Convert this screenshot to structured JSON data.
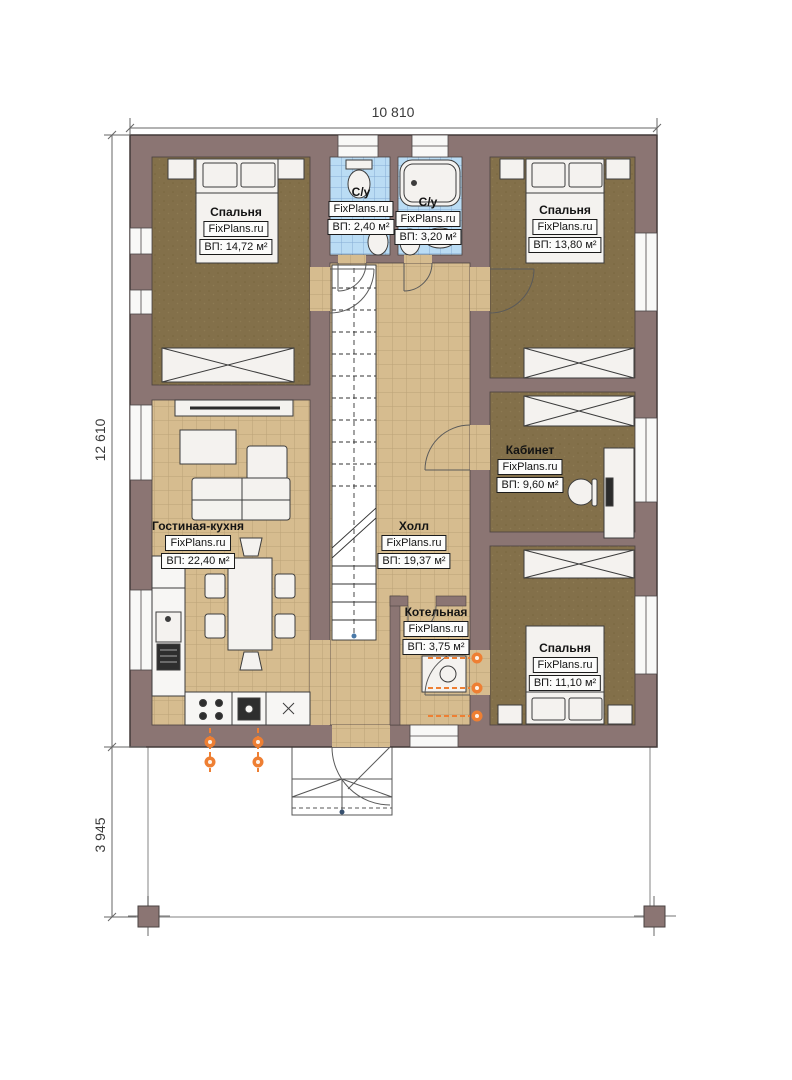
{
  "watermark": "FixPlans.ru",
  "dimensions": {
    "width_total": "10 810",
    "height_main": "12 610",
    "height_terrace": "3 945"
  },
  "rooms": [
    {
      "id": "bedroom-top-left",
      "name": "Спальня",
      "area": "ВП: 14,72 м²"
    },
    {
      "id": "bathroom-small",
      "name": "С/у",
      "area": "ВП: 2,40 м²"
    },
    {
      "id": "bathroom-large",
      "name": "С/у",
      "area": "ВП: 3,20 м²"
    },
    {
      "id": "bedroom-top-right",
      "name": "Спальня",
      "area": "ВП: 13,80 м²"
    },
    {
      "id": "office",
      "name": "Кабинет",
      "area": "ВП: 9,60 м²"
    },
    {
      "id": "living-kitchen",
      "name": "Гостиная-кухня",
      "area": "ВП: 22,40 м²"
    },
    {
      "id": "hall",
      "name": "Холл",
      "area": "ВП: 19,37 м²"
    },
    {
      "id": "boiler-room",
      "name": "Котельная",
      "area": "ВП: 3,75 м²"
    },
    {
      "id": "bedroom-bottom-right",
      "name": "Спальня",
      "area": "ВП: 11,10 м²"
    }
  ],
  "colors": {
    "wall": "#8b7573",
    "wood_floor": "#83704a",
    "tile_floor": "#d6bc8f",
    "bath_tile": "#badcf4",
    "radiator": "#ee7f33"
  }
}
